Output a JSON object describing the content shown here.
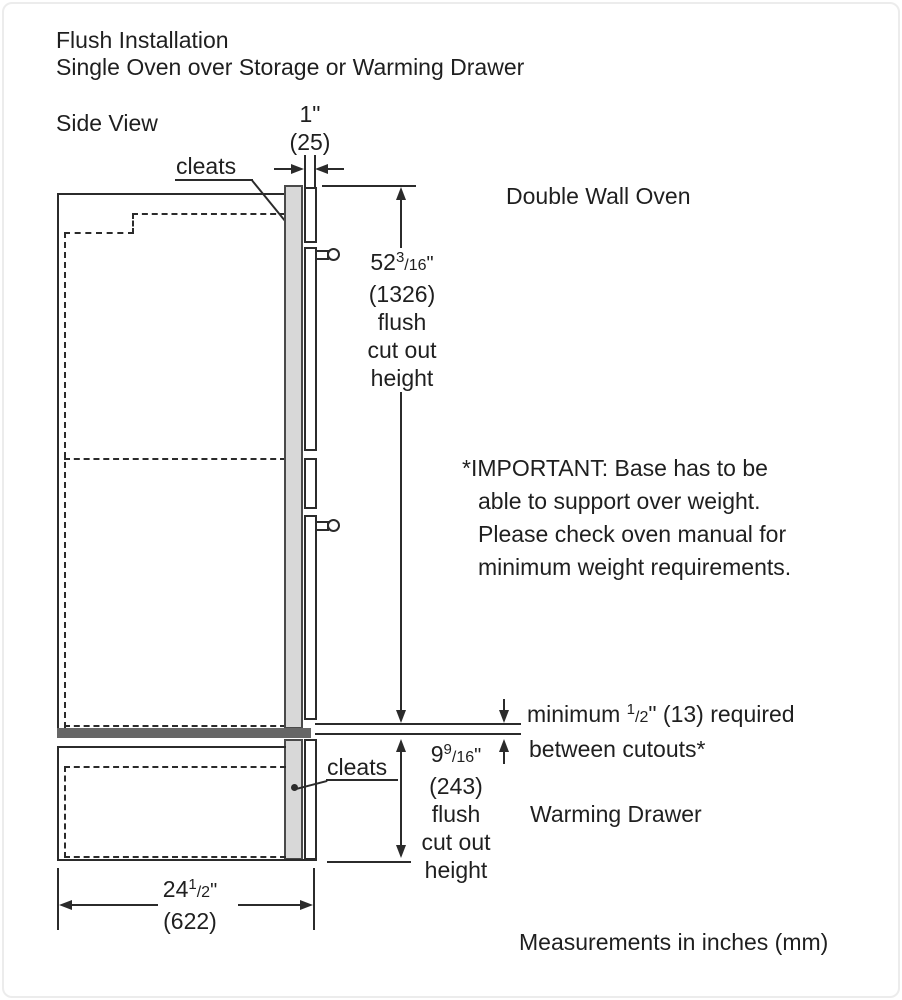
{
  "colors": {
    "line": "#2b2b2b",
    "cleat_fill": "#d8d8d8",
    "cleat_border": "#4a4a4a",
    "shelf_fill": "#666666",
    "text": "#1f1f1f",
    "frame": "#ececec"
  },
  "title": {
    "line1": "Flush Installation",
    "line2": "Single Oven over Storage or Warming Drawer"
  },
  "view_label": "Side View",
  "labels": {
    "cleats_top": "cleats",
    "cleats_bottom": "cleats",
    "oven": "Double Wall Oven",
    "drawer": "Warming Drawer"
  },
  "dims": {
    "overhang": {
      "inches": "1\"",
      "mm": "(25)"
    },
    "oven_cutout": {
      "whole": "52",
      "sup": "3",
      "den": "/16",
      "quote": "\"",
      "mm": "(1326)",
      "desc1": "flush",
      "desc2": "cut out",
      "desc3": "height"
    },
    "drawer_cutout": {
      "whole": "9",
      "sup": "9",
      "den": "/16",
      "quote": "\"",
      "mm": "(243)",
      "desc1": "flush",
      "desc2": "cut out",
      "desc3": "height"
    },
    "width": {
      "whole": "24",
      "sup": "1",
      "den": "/2",
      "quote": "\"",
      "mm": "(622)"
    },
    "min_gap": {
      "pre": "minimum ",
      "sup": "1",
      "den": "/2",
      "post": "\" (13) required",
      "line2": "between cutouts*"
    }
  },
  "note": {
    "line1": "*IMPORTANT: Base has to be",
    "line2": "able to support over weight.",
    "line3": "Please check oven manual for",
    "line4": "minimum weight requirements."
  },
  "footer": "Measurements in inches (mm)"
}
